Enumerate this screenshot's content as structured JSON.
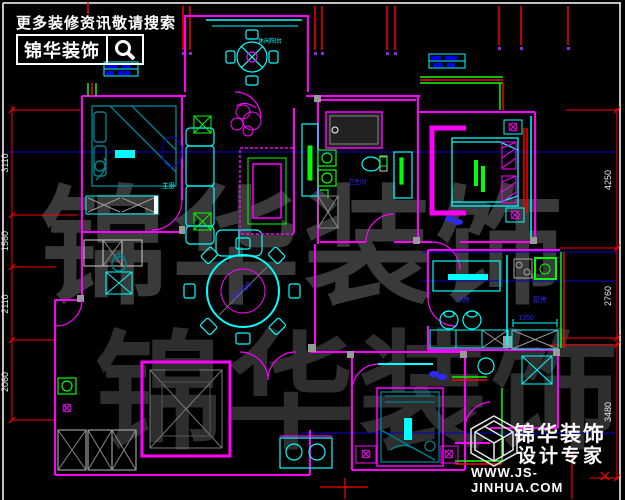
{
  "palette": {
    "background": "#000000",
    "wall_magenta": "#ff00ff",
    "furniture_cyan": "#00ffff",
    "furniture_teal": "#00808f",
    "accent_green": "#00ff00",
    "dimension_red": "#ff0000",
    "axis_blue": "#0000cc",
    "label_blue": "#2a2aff",
    "text_white": "#ffffff",
    "watermark_gray": "#3a3a3a"
  },
  "header": {
    "slogan": "更多装修资讯敬请搜索",
    "brand": "锦华装饰"
  },
  "brand_footer": {
    "brand": "锦华装饰",
    "tagline": "设计专家",
    "website": "WWW.JS-JINHUA.COM"
  },
  "watermark": {
    "text": "锦华装饰"
  },
  "dimensions": {
    "left": [
      "3110",
      "1560",
      "2110",
      "2060"
    ],
    "right": [
      "4250",
      "2760",
      "3480"
    ],
    "dining_table": "Φ1400",
    "kitchen_cabinet": "1350"
  },
  "room_labels": {
    "balcony": "休闲阳台",
    "bedroom_left": "主卧",
    "bathroom": "卫生间",
    "study": "书房",
    "kitchen": "厨房"
  }
}
